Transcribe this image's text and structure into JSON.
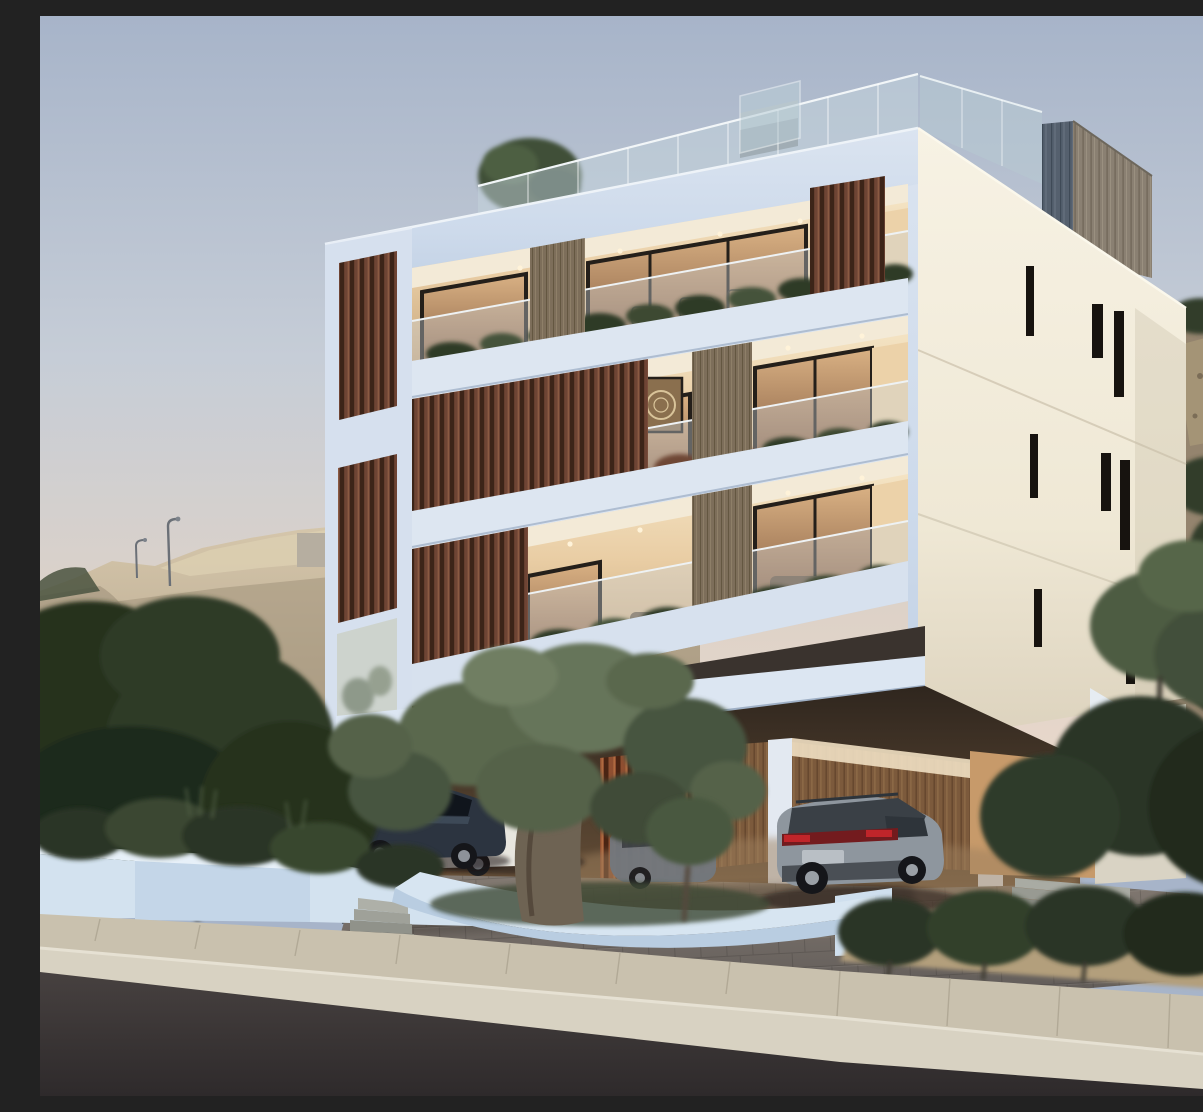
{
  "scene": {
    "type": "architectural-3d-rendering",
    "title": "Modern three-storey apartment building at dusk",
    "description": "Dusk exterior rendering of a modern white three-storey apartment block with vertical wood-slat screens, glass-railed balconies planted with shrubs, warm interior lighting, a rooftop glass-railed terrace with a wood-clad stair box, an open carport with parked cars (dark sedan, white car, silver car, grey SUV), a large olive tree in a curved white planter, white retaining planter walls, a paved sidewalk and a sloping asphalt road, set against sandy excavated hills with street lamps and dark green trees",
    "time_of_day": "dusk",
    "setting": "hillside residential street"
  },
  "building": {
    "storeys": 3,
    "balcony_rows": 3,
    "features": [
      "glass balustrades",
      "vertical wood slat screens",
      "wood-clad columns",
      "recessed warm-lit interiors",
      "balcony planters",
      "rooftop glass railing",
      "wood-clad roof box",
      "narrow slit windows on side wall",
      "open carport",
      "white beam and columns"
    ],
    "side_wall_slit_windows": 6,
    "downlights_per_floor": 4
  },
  "vehicles": [
    {
      "name": "dark-sedan",
      "color": "#2c3440",
      "position": "under building, left carport",
      "detail": "red tail lights, white licence plate"
    },
    {
      "name": "white-car",
      "color": "#e8e6df",
      "position": "behind dark sedan"
    },
    {
      "name": "silver-car",
      "color": "#9aa0a6",
      "position": "partially hidden behind olive tree"
    },
    {
      "name": "grey-suv",
      "color": "#8e969e",
      "position": "driveway, right carport bay",
      "detail": "rear view, red tail light band"
    }
  ],
  "environment": {
    "left_hill": "sandy excavated hillside with dirt mounds and small concrete wall",
    "right_hill": "rocky scrub hillside with dark shrubs",
    "street_lamps": 2,
    "trees": [
      "rooftop terrace tree",
      "large foreground olive tree in curved white planter",
      "dark green tree cluster left",
      "olive trees right hillside",
      "hedge bushes along sidewalk"
    ],
    "road": "dark asphalt, sloping down to the right",
    "sidewalk": "light stone pavers with concrete curb"
  },
  "colors": {
    "sky-top": "#a7b4c9",
    "sky-mid": "#c6cdd7",
    "sky-horizon": "#e9d8cb",
    "facade-front": "#cddaeb",
    "facade-side": "#f3eee0",
    "wood-slat": "#6e4434",
    "wood-slat-rust": "#8f4f31",
    "wood-column": "#7d6e5a",
    "roofbox-front": "#8a8072",
    "roofbox-side": "#55606e",
    "interior-warm": "#e9cda4",
    "window-frame": "#241f1a",
    "glass-rail": "#ccd6da",
    "plant-dark": "#2e3b28",
    "plant-rust": "#6e4734",
    "tree-dark": "#27311f",
    "olive-green": "#5a684e",
    "hill-sand": "#c9b99f",
    "hill-rock": "#94846e",
    "driveway": "#736c66",
    "sidewalk": "#c9c1ae",
    "curb": "#d8d2c2",
    "road": "#3a3536",
    "planter-wall": "#d3e2ef",
    "tail-light": "#c0252a"
  }
}
